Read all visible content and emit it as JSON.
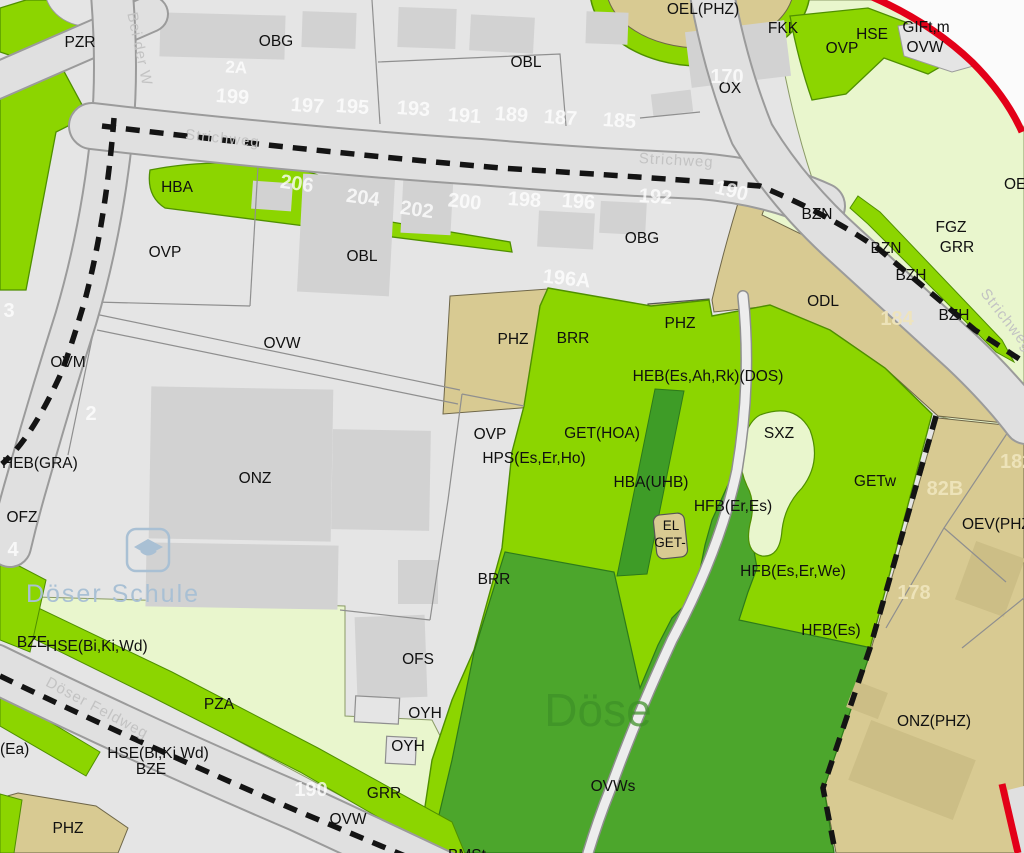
{
  "map": {
    "palette": {
      "parcel_gray": "#E5E5E5",
      "building_gray": "#D2D2D2",
      "road_gray": "#E0E0E0",
      "road_edge": "#9B9B9B",
      "bright_green": "#8CD500",
      "dark_green": "#4CA62C",
      "tree_strip_green": "#3E9C27",
      "pale_green": "#E9F6CD",
      "tan": "#D8CA92",
      "building_tan": "#CCBE86",
      "red_boundary": "#E30018",
      "dashed_boundary": "#141414"
    },
    "labels": [
      {
        "t": "PZR",
        "x": 80,
        "y": 47,
        "c": "zone"
      },
      {
        "t": "OBG",
        "x": 276,
        "y": 46,
        "c": "zone"
      },
      {
        "t": "OBL",
        "x": 526,
        "y": 67,
        "c": "zone"
      },
      {
        "t": "OEL(PHZ)",
        "x": 703,
        "y": 14,
        "c": "zone"
      },
      {
        "t": "FKK",
        "x": 783,
        "y": 33,
        "c": "zone"
      },
      {
        "t": "OVP",
        "x": 842,
        "y": 53,
        "c": "zone"
      },
      {
        "t": "HSE",
        "x": 872,
        "y": 39,
        "c": "zone"
      },
      {
        "t": "GIFt,m",
        "x": 926,
        "y": 32,
        "c": "zone"
      },
      {
        "t": "OVW",
        "x": 925,
        "y": 52,
        "c": "zone"
      },
      {
        "t": "OX",
        "x": 730,
        "y": 93,
        "c": "zone"
      },
      {
        "t": "HBA",
        "x": 177,
        "y": 192,
        "c": "zone"
      },
      {
        "t": "OVP",
        "x": 165,
        "y": 257,
        "c": "zone"
      },
      {
        "t": "OBL",
        "x": 362,
        "y": 261,
        "c": "zone"
      },
      {
        "t": "OBG",
        "x": 642,
        "y": 243,
        "c": "zone"
      },
      {
        "t": "BZN",
        "x": 817,
        "y": 219,
        "c": "zone"
      },
      {
        "t": "BZN",
        "x": 886,
        "y": 253,
        "c": "zone"
      },
      {
        "t": "BZH",
        "x": 911,
        "y": 280,
        "c": "zone"
      },
      {
        "t": "BZH",
        "x": 954,
        "y": 320,
        "c": "zone"
      },
      {
        "t": "FGZ",
        "x": 951,
        "y": 232,
        "c": "zone"
      },
      {
        "t": "GRR",
        "x": 957,
        "y": 252,
        "c": "zone"
      },
      {
        "t": "ODL",
        "x": 823,
        "y": 306,
        "c": "zone"
      },
      {
        "t": "OE",
        "x": 1004,
        "y": 189,
        "c": "zone",
        "a": "start"
      },
      {
        "t": "OVW",
        "x": 282,
        "y": 348,
        "c": "zone"
      },
      {
        "t": "OVM",
        "x": 68,
        "y": 367,
        "c": "zone"
      },
      {
        "t": "PHZ",
        "x": 513,
        "y": 344,
        "c": "zone"
      },
      {
        "t": "BRR",
        "x": 573,
        "y": 343,
        "c": "zone"
      },
      {
        "t": "PHZ",
        "x": 680,
        "y": 328,
        "c": "zone"
      },
      {
        "t": "HEB(Es,Ah,Rk)(DOS)",
        "x": 708,
        "y": 381,
        "c": "zone"
      },
      {
        "t": "HEB(GRA)",
        "x": 2,
        "y": 468,
        "c": "zone",
        "a": "start"
      },
      {
        "t": "OFZ",
        "x": 22,
        "y": 522,
        "c": "zone"
      },
      {
        "t": "ONZ",
        "x": 255,
        "y": 483,
        "c": "zone"
      },
      {
        "t": "GET(HOA)",
        "x": 602,
        "y": 438,
        "c": "zone"
      },
      {
        "t": "OVP",
        "x": 490,
        "y": 439,
        "c": "zone"
      },
      {
        "t": "HPS(Es,Er,Ho)",
        "x": 534,
        "y": 463,
        "c": "zone"
      },
      {
        "t": "HBA(UHB)",
        "x": 651,
        "y": 487,
        "c": "zone"
      },
      {
        "t": "SXZ",
        "x": 779,
        "y": 438,
        "c": "zone"
      },
      {
        "t": "GETw",
        "x": 875,
        "y": 486,
        "c": "zone"
      },
      {
        "t": "HFB(Er,Es)",
        "x": 733,
        "y": 511,
        "c": "zone"
      },
      {
        "t": "EL",
        "x": 671,
        "y": 530,
        "c": "zoneS"
      },
      {
        "t": "GET-",
        "x": 670,
        "y": 547,
        "c": "zoneS"
      },
      {
        "t": "HFB(Es,Er,We)",
        "x": 793,
        "y": 576,
        "c": "zone"
      },
      {
        "t": "HFB(Es)",
        "x": 831,
        "y": 635,
        "c": "zone"
      },
      {
        "t": "OEV(PHZ)",
        "x": 962,
        "y": 529,
        "c": "zone",
        "a": "start"
      },
      {
        "t": "ONZ(PHZ)",
        "x": 934,
        "y": 726,
        "c": "zone"
      },
      {
        "t": "BRR",
        "x": 494,
        "y": 584,
        "c": "zone"
      },
      {
        "t": "OFS",
        "x": 418,
        "y": 664,
        "c": "zone"
      },
      {
        "t": "OYH",
        "x": 425,
        "y": 718,
        "c": "zone"
      },
      {
        "t": "OYH",
        "x": 408,
        "y": 751,
        "c": "zone"
      },
      {
        "t": "GRR",
        "x": 384,
        "y": 798,
        "c": "zone"
      },
      {
        "t": "OVW",
        "x": 348,
        "y": 824,
        "c": "zone"
      },
      {
        "t": "OVWs",
        "x": 613,
        "y": 791,
        "c": "zone"
      },
      {
        "t": "BZE",
        "x": 32,
        "y": 647,
        "c": "zone"
      },
      {
        "t": "HSE(Bi,Ki,Wd)",
        "x": 46,
        "y": 651,
        "c": "zone",
        "a": "start"
      },
      {
        "t": "HSE(Bi,Ki,Wd)",
        "x": 158,
        "y": 758,
        "c": "zone"
      },
      {
        "t": "BZE",
        "x": 151,
        "y": 774,
        "c": "zone"
      },
      {
        "t": "(Ea)",
        "x": 0,
        "y": 754,
        "c": "zone",
        "a": "start"
      },
      {
        "t": "PZA",
        "x": 219,
        "y": 709,
        "c": "zone"
      },
      {
        "t": "PHZ",
        "x": 68,
        "y": 833,
        "c": "zone"
      },
      {
        "t": "BMSt",
        "x": 467,
        "y": 860,
        "c": "zone"
      },
      {
        "t": "2A",
        "x": 236,
        "y": 73,
        "c": "numS",
        "rot": 3
      },
      {
        "t": "199",
        "x": 232,
        "y": 103,
        "c": "num",
        "rot": 4
      },
      {
        "t": "197",
        "x": 307,
        "y": 112,
        "c": "num",
        "rot": 4
      },
      {
        "t": "195",
        "x": 352,
        "y": 113,
        "c": "num",
        "rot": 4
      },
      {
        "t": "193",
        "x": 413,
        "y": 115,
        "c": "num",
        "rot": 4
      },
      {
        "t": "191",
        "x": 464,
        "y": 122,
        "c": "num",
        "rot": 4
      },
      {
        "t": "189",
        "x": 511,
        "y": 121,
        "c": "num",
        "rot": 4
      },
      {
        "t": "187",
        "x": 560,
        "y": 124,
        "c": "num",
        "rot": 4
      },
      {
        "t": "185",
        "x": 619,
        "y": 127,
        "c": "num",
        "rot": 4
      },
      {
        "t": "170",
        "x": 727,
        "y": 83,
        "c": "num"
      },
      {
        "t": "206",
        "x": 296,
        "y": 190,
        "c": "num",
        "rot": 8
      },
      {
        "t": "204",
        "x": 362,
        "y": 204,
        "c": "num",
        "rot": 8
      },
      {
        "t": "202",
        "x": 416,
        "y": 216,
        "c": "num",
        "rot": 8
      },
      {
        "t": "200",
        "x": 464,
        "y": 208,
        "c": "num",
        "rot": 6
      },
      {
        "t": "198",
        "x": 524,
        "y": 206,
        "c": "num",
        "rot": 4
      },
      {
        "t": "196",
        "x": 578,
        "y": 208,
        "c": "num",
        "rot": 4
      },
      {
        "t": "192",
        "x": 655,
        "y": 203,
        "c": "num",
        "rot": 4
      },
      {
        "t": "190",
        "x": 730,
        "y": 197,
        "c": "num",
        "rot": 14
      },
      {
        "t": "196A",
        "x": 566,
        "y": 285,
        "c": "num",
        "rot": 6
      },
      {
        "t": "2",
        "x": 91,
        "y": 420,
        "c": "num"
      },
      {
        "t": "3",
        "x": 9,
        "y": 317,
        "c": "num"
      },
      {
        "t": "4",
        "x": 13,
        "y": 556,
        "c": "num"
      },
      {
        "t": "190",
        "x": 311,
        "y": 796,
        "c": "num"
      },
      {
        "t": "184",
        "x": 897,
        "y": 325,
        "c": "numT"
      },
      {
        "t": "82B",
        "x": 945,
        "y": 495,
        "c": "numT"
      },
      {
        "t": "178",
        "x": 914,
        "y": 599,
        "c": "numT"
      },
      {
        "t": "182",
        "x": 1000,
        "y": 468,
        "c": "numT",
        "a": "start"
      },
      {
        "t": "Strichweg",
        "x": 222,
        "y": 143,
        "c": "street",
        "rot": 6
      },
      {
        "t": "Strichweg",
        "x": 676,
        "y": 165,
        "c": "street",
        "rot": 3
      },
      {
        "t": "Strichweg",
        "x": 1003,
        "y": 323,
        "c": "street",
        "rot": 52
      },
      {
        "t": "Bei der W",
        "x": 135,
        "y": 50,
        "c": "street",
        "rot": 78
      },
      {
        "t": "Döser Feldweg",
        "x": 95,
        "y": 712,
        "c": "street",
        "rot": 28
      },
      {
        "t": "Döse",
        "x": 598,
        "y": 726,
        "c": "wmg"
      },
      {
        "t": "Döser Schule",
        "x": 113,
        "y": 602,
        "c": "wmb"
      }
    ]
  }
}
